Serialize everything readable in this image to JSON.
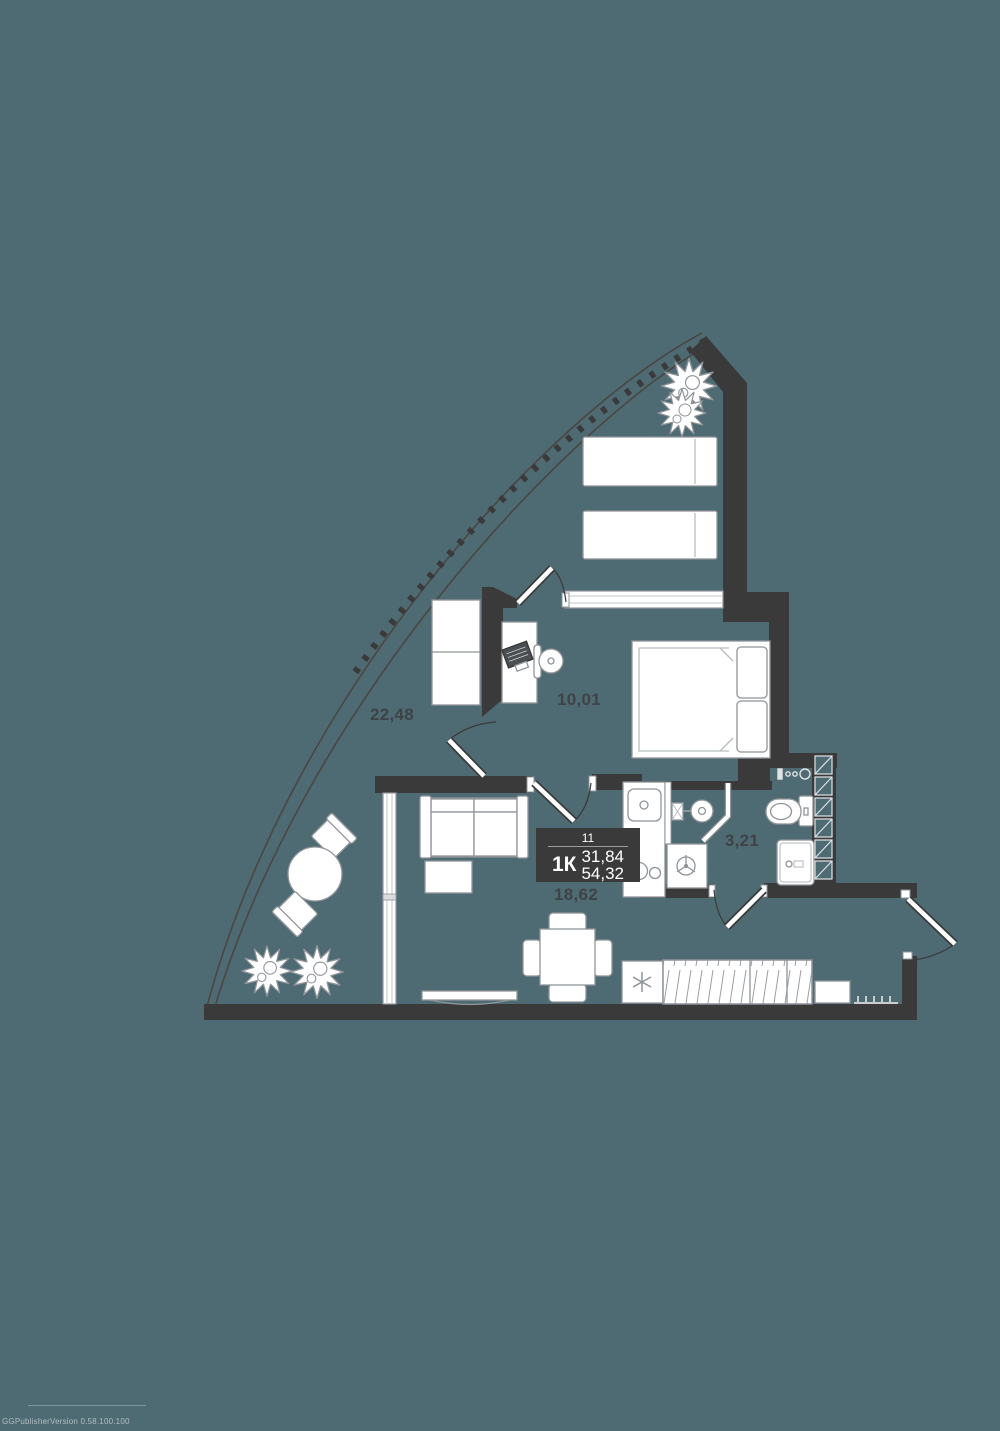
{
  "window": {
    "width": 1000,
    "height": 1431
  },
  "palette": {
    "background": "#4e6a73",
    "wall": "#3a3a3b",
    "furniture_outline": "#8f9499",
    "furniture_fill": "#ffffff",
    "label_text": "#3f4347",
    "info_box_bg": "#3a3a3b",
    "info_box_text": "#ffffff"
  },
  "plan": {
    "type": "apartment-floor-plan",
    "info_box": {
      "apartment_number": "11",
      "layout_label": "1К",
      "area_primary": "31,84",
      "area_secondary": "54,32"
    },
    "rooms": [
      {
        "name": "terrace",
        "area_label": "22,48"
      },
      {
        "name": "bedroom",
        "area_label": "10,01"
      },
      {
        "name": "bathroom",
        "area_label": "3,21"
      },
      {
        "name": "living-kitchen",
        "area_label": "18,62"
      }
    ],
    "furniture": {
      "terrace": [
        "potted-plant",
        "potted-plant",
        "sunbed",
        "sunbed",
        "round-table",
        "chair",
        "chair",
        "potted-plant",
        "potted-plant"
      ],
      "bedroom": [
        "wardrobe",
        "desk",
        "laptop",
        "desk-chair",
        "double-bed"
      ],
      "living_kitchen": [
        "sofa",
        "coffee-table",
        "tv",
        "dining-table",
        "chairs",
        "kitchen-sink",
        "stove",
        "refrigerator",
        "built-in-wardrobe",
        "shoe-bench",
        "coat-hooks"
      ],
      "bathroom": [
        "wash-basin",
        "shower",
        "toilet",
        "washing-machine",
        "utility-shaft",
        "utility-meters"
      ]
    }
  },
  "watermark": "GGPublisherVersion 0.58.100.100"
}
